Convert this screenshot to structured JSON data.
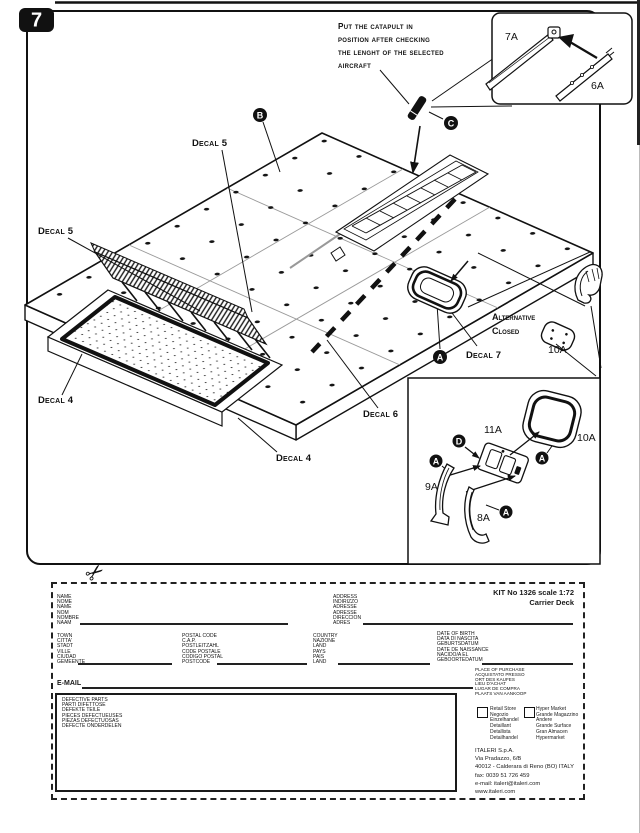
{
  "page": {
    "step_number": "7",
    "note": {
      "line1": "Put the catapult in",
      "line2": "position after checking",
      "line3": "the lenght of the selected",
      "line4": "aircraft"
    },
    "callouts": {
      "a": "A",
      "b": "B",
      "c": "C",
      "d": "D"
    },
    "decals": {
      "d4": "Decal 4",
      "d5": "Decal 5",
      "d6": "Decal 6",
      "d7": "Decal 7"
    },
    "alt": {
      "line1": "Alternative",
      "line2": "Closed"
    },
    "parts": {
      "p6a": "6A",
      "p7a": "7A",
      "p8a": "8A",
      "p9a": "9A",
      "p10a": "10A",
      "p11a": "11A"
    },
    "icons": {
      "scissors": "✂"
    }
  },
  "form": {
    "kit": "KIT No 1326 scale 1:72\nCarrier Deck",
    "fields": {
      "name": "NAME\nNOME\nNAME\nNOM\nNOMBRE\nNAAM",
      "address": "ADDRESS\nINDIRIZZO\nADRESSE\nADRESSE\nDIRECCION\nADRES",
      "town": "TOWN\nCITTA'\nSTADT\nVILLE\nCIUDAD\nGEMEENTE",
      "postal": "POSTAL CODE\nC.A.P.\nPOSTLEITZAHL\nCODE POSTALE\nCODIGO POSTAL\nPOSTCODE",
      "country": "COUNTRY\nNAZIONE\nLAND\nPAYS\nPAIS\nLAND",
      "birth": "DATE OF BIRTH\nDATA DI NASCITA\nGEBURTSDATUM\nDATE DE NAISSANCE\nNACIDO/A EL\nGEBOORTEDATUM",
      "email": "E-MAIL",
      "defective": "DEFECTIVE PARTS\nPARTI DIFETTOSE\nDEFEKTE TEILE\nPIECES DEFECTUEUSES\nPIEZAS DEFECTUOSAS\nDEFECTE ONDERDELEN",
      "purchase": "PLACE OF PURCHASE\nACQUISTATO PRESSO\nORT DES KAUFES\nLIEU D'ACHAT\nLUGAR DE COMPRA\nPLAATS VAN AANKOOP",
      "retail": "Retail Store\nNegozio\nEinzelhandel\nDetaillant\nDetallista\nDetailhandel",
      "hyper": "Hyper Market\nGrande Magazzino\nAndere\nGrande Surface\nGran Almacen\nHypermarket"
    },
    "company": "ITALERI S.p.A.\nVia Pradazzo, 6/B\n40012 - Calderara di Reno (BO) ITALY\nfax: 0039 51 726 459\ne-mail: italeri@italeri.com\nwww.italeri.com"
  }
}
